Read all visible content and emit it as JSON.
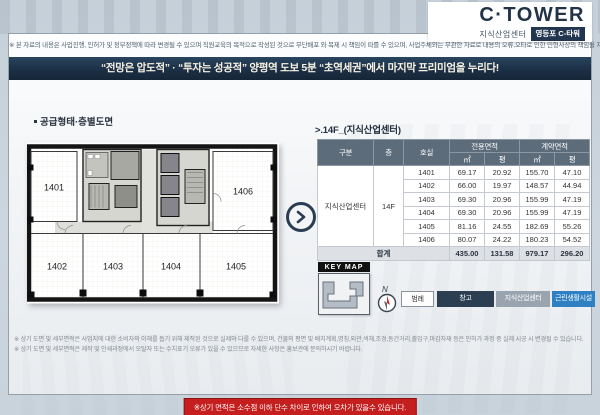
{
  "header": {
    "disclaimer": "※ 본 자료의 내용은 사업진행, 인허가 및 정부정책에 따라 변경될 수 있으며 직원교육의 목적으로 작성된 것으로 무단배포 와 복제 시 책임이 따를 수 있으며, 사업주체와는 무관한 자료로 내용의 오류,오타로 인한 민형사상의 책임을 지지 않습니다",
    "logo": {
      "brand": "C·TOWER",
      "category": "지식산업센터",
      "badge": "영등포 C-타워"
    },
    "banner": "“전망은 압도적” · “투자는 성공적” 양평역 도보 5분 “초역세권”에서 마지막 프리미엄을 누리다!"
  },
  "floorplan": {
    "section_title": "공급형태·층별도면",
    "rooms": [
      "1401",
      "1402",
      "1403",
      "1404",
      "1405",
      "1406"
    ]
  },
  "units": {
    "section_title": ">.14F_(지식산업센터)",
    "table": {
      "col_gubun": "구분",
      "col_floor": "층",
      "col_room": "호실",
      "col_exclusive": "전용면적",
      "col_contract": "계약면적",
      "unit_m2": "㎡",
      "unit_py": "평",
      "category": "지식산업센터",
      "floor": "14F",
      "rows": [
        {
          "room": "1401",
          "ex_m2": "69.17",
          "ex_py": "20.92",
          "ct_m2": "155.70",
          "ct_py": "47.10"
        },
        {
          "room": "1402",
          "ex_m2": "66.00",
          "ex_py": "19.97",
          "ct_m2": "148.57",
          "ct_py": "44.94"
        },
        {
          "room": "1403",
          "ex_m2": "69.30",
          "ex_py": "20.96",
          "ct_m2": "155.99",
          "ct_py": "47.19"
        },
        {
          "room": "1404",
          "ex_m2": "69.30",
          "ex_py": "20.96",
          "ct_m2": "155.99",
          "ct_py": "47.19"
        },
        {
          "room": "1405",
          "ex_m2": "81.16",
          "ex_py": "24.55",
          "ct_m2": "182.69",
          "ct_py": "55.26"
        },
        {
          "room": "1406",
          "ex_m2": "80.07",
          "ex_py": "24.22",
          "ct_m2": "180.23",
          "ct_py": "54.52"
        }
      ],
      "total": {
        "label": "합계",
        "ex_m2": "435.00",
        "ex_py": "131.58",
        "ct_m2": "979.17",
        "ct_py": "296.20"
      }
    },
    "keymap_label": "KEY MAP",
    "compass": "N",
    "legend": {
      "title": "범례",
      "items": [
        {
          "label": "창고",
          "color": "#2c3e52"
        },
        {
          "label": "지식산업센터",
          "color": "#9aa4af"
        },
        {
          "label": "근린생활시설",
          "color": "#2e80c2"
        }
      ]
    }
  },
  "footer": {
    "note1": "※ 상기 도면 및 세부면적은 사업지에 대한 소비자의 이해를 돕기 위해 제작된 것으로 실제와 다를 수 있으며, 건물의 평면 및 배치계획,명칭,외관,색채,조경,동간거리,출입구,마감자재 등은 인허가 과정 중 실제 시공 시 변경될 수 있습니다.",
    "note2": "※ 상기 도면 및 세부면적은 제작 및 인쇄과정에서 오탈자 또는 수치표기 오류가 있을 수 있으므로 자세한 사항은 홍보관에 문의하시기 바랍니다.",
    "notice": "※상기 면적은 소수점 이하 단수 차이로 인하여 오차가 있을수 있습니다."
  },
  "colors": {
    "navy": "#1c2f45",
    "table_header": "#5d6c7b",
    "legend_dark": "#2c3e52",
    "legend_gray": "#9aa4af",
    "legend_blue": "#2e80c2",
    "notice_red": "#c41e1e"
  }
}
